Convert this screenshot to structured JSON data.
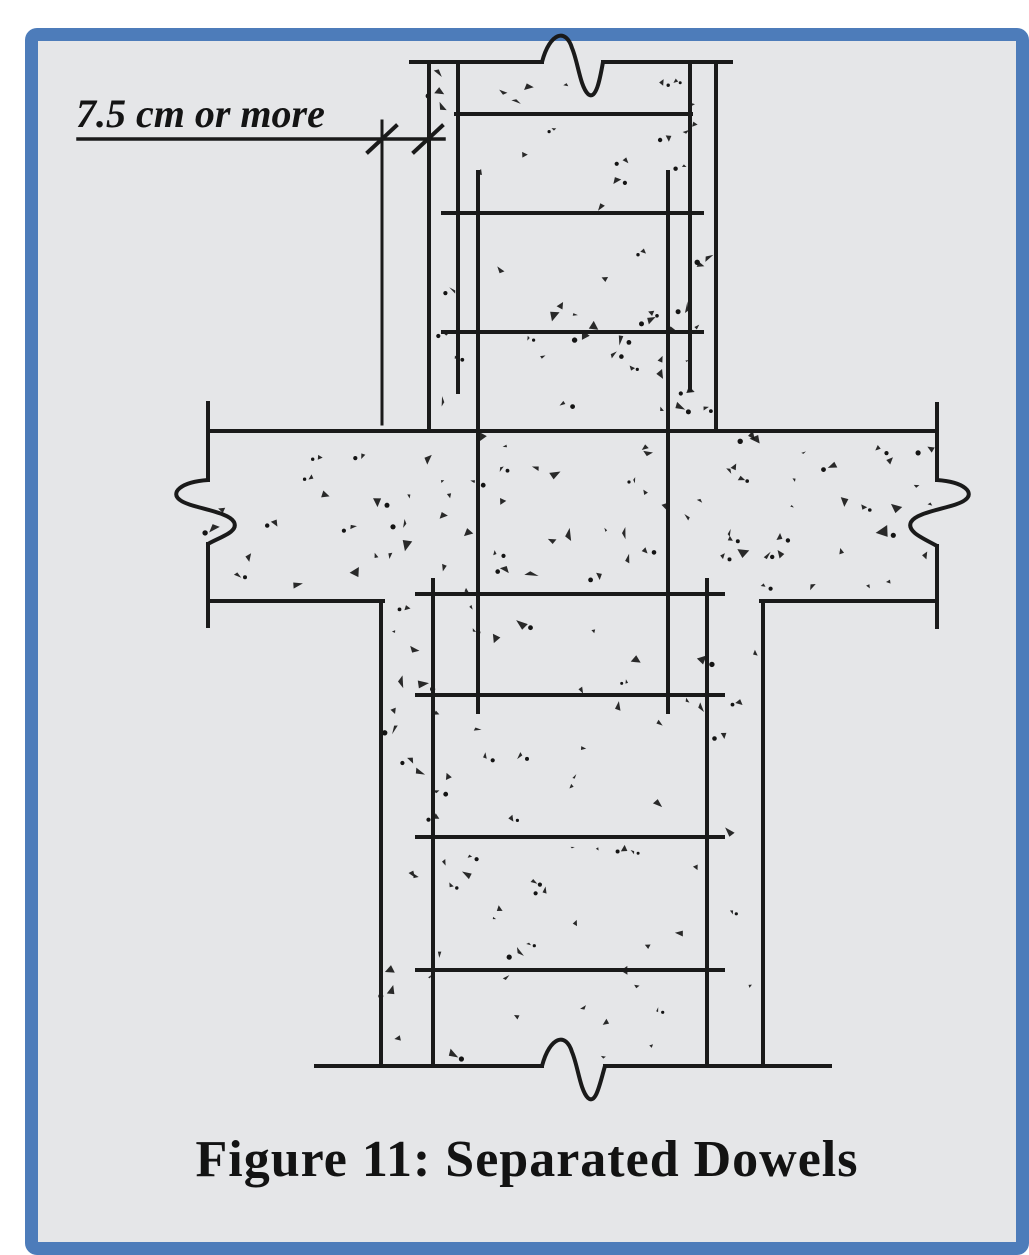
{
  "figure": {
    "annotation": "7.5 cm or more",
    "caption": "Figure 11: Separated Dowels"
  },
  "colors": {
    "frame_blue": "#4d7cba",
    "canvas_gray": "#e5e6e8",
    "line_black": "#1a1a1a",
    "stipple_black": "#141414",
    "page_white": "#ffffff"
  },
  "drawing": {
    "lines": [
      {
        "n": "dimension-line",
        "x1": 78,
        "y1": 139,
        "x2": 444,
        "y2": 139,
        "w": 3.5
      },
      {
        "n": "dimension-extension-line",
        "x1": 382,
        "y1": 121,
        "x2": 382,
        "y2": 424,
        "w": 3
      },
      {
        "n": "dimension-tick-left",
        "x1": 368,
        "y1": 152,
        "x2": 396,
        "y2": 126,
        "w": 4
      },
      {
        "n": "dimension-tick-right",
        "x1": 414,
        "y1": 152,
        "x2": 442,
        "y2": 126,
        "w": 4
      },
      {
        "n": "upper-column-top-edge-left",
        "x1": 411,
        "y1": 62,
        "x2": 542,
        "y2": 62,
        "w": 4
      },
      {
        "n": "upper-column-top-edge-right",
        "x1": 603,
        "y1": 62,
        "x2": 731,
        "y2": 62,
        "w": 4
      },
      {
        "n": "upper-column-left-edge",
        "x1": 429,
        "y1": 62,
        "x2": 429,
        "y2": 431,
        "w": 4
      },
      {
        "n": "upper-column-right-edge",
        "x1": 716,
        "y1": 62,
        "x2": 716,
        "y2": 431,
        "w": 4
      },
      {
        "n": "upper-column-rebar-left",
        "x1": 458,
        "y1": 62,
        "x2": 458,
        "y2": 392,
        "w": 4
      },
      {
        "n": "upper-column-rebar-right",
        "x1": 690,
        "y1": 62,
        "x2": 690,
        "y2": 390,
        "w": 4
      },
      {
        "n": "dowel-bar-left",
        "x1": 478,
        "y1": 172,
        "x2": 478,
        "y2": 712,
        "w": 4
      },
      {
        "n": "dowel-bar-right",
        "x1": 668,
        "y1": 172,
        "x2": 668,
        "y2": 712,
        "w": 4
      },
      {
        "n": "upper-column-tie-1",
        "x1": 456,
        "y1": 114,
        "x2": 691,
        "y2": 114,
        "w": 4
      },
      {
        "n": "upper-column-tie-2",
        "x1": 443,
        "y1": 213,
        "x2": 702,
        "y2": 213,
        "w": 4
      },
      {
        "n": "upper-column-tie-3",
        "x1": 443,
        "y1": 332,
        "x2": 702,
        "y2": 332,
        "w": 4
      },
      {
        "n": "slab-top-edge",
        "x1": 208,
        "y1": 431,
        "x2": 937,
        "y2": 431,
        "w": 4
      },
      {
        "n": "slab-bottom-edge-left",
        "x1": 208,
        "y1": 601,
        "x2": 383,
        "y2": 601,
        "w": 4
      },
      {
        "n": "slab-bottom-edge-right",
        "x1": 761,
        "y1": 601,
        "x2": 937,
        "y2": 601,
        "w": 4
      },
      {
        "n": "slab-left-edge-upper",
        "x1": 208,
        "y1": 403,
        "x2": 208,
        "y2": 480,
        "w": 4
      },
      {
        "n": "slab-left-edge-lower",
        "x1": 208,
        "y1": 544,
        "x2": 208,
        "y2": 626,
        "w": 4
      },
      {
        "n": "slab-right-edge-upper",
        "x1": 937,
        "y1": 404,
        "x2": 937,
        "y2": 480,
        "w": 4
      },
      {
        "n": "slab-right-edge-lower",
        "x1": 937,
        "y1": 546,
        "x2": 937,
        "y2": 627,
        "w": 4
      },
      {
        "n": "lower-column-left-edge",
        "x1": 381,
        "y1": 601,
        "x2": 381,
        "y2": 1066,
        "w": 4
      },
      {
        "n": "lower-column-right-edge",
        "x1": 763,
        "y1": 601,
        "x2": 763,
        "y2": 1066,
        "w": 4
      },
      {
        "n": "lower-column-rebar-left",
        "x1": 433,
        "y1": 580,
        "x2": 433,
        "y2": 1066,
        "w": 4
      },
      {
        "n": "lower-column-rebar-right",
        "x1": 707,
        "y1": 580,
        "x2": 707,
        "y2": 1066,
        "w": 4
      },
      {
        "n": "lower-column-tie-1",
        "x1": 417,
        "y1": 594,
        "x2": 723,
        "y2": 594,
        "w": 4
      },
      {
        "n": "lower-column-tie-2",
        "x1": 417,
        "y1": 695,
        "x2": 723,
        "y2": 695,
        "w": 4
      },
      {
        "n": "lower-column-tie-3",
        "x1": 417,
        "y1": 837,
        "x2": 723,
        "y2": 837,
        "w": 4
      },
      {
        "n": "lower-column-tie-4",
        "x1": 417,
        "y1": 970,
        "x2": 723,
        "y2": 970,
        "w": 4
      },
      {
        "n": "lower-column-base-left",
        "x1": 316,
        "y1": 1066,
        "x2": 542,
        "y2": 1066,
        "w": 4
      },
      {
        "n": "lower-column-base-right",
        "x1": 605,
        "y1": 1066,
        "x2": 830,
        "y2": 1066,
        "w": 4
      }
    ],
    "paths": [
      {
        "n": "break-symbol-top",
        "d": "M542,62 C550,32 566,28 572,48 C578,62 580,86 588,94 C596,101 600,79 603,62",
        "w": 4
      },
      {
        "n": "break-symbol-bottom",
        "d": "M542,1066 C550,1036 566,1032 572,1052 C578,1066 580,1090 588,1098 C596,1105 600,1083 605,1066",
        "w": 4
      },
      {
        "n": "break-symbol-left",
        "d": "M208,480 C180,482 170,493 180,500 C190,508 228,511 234,522 C239,532 220,537 208,544",
        "w": 4
      },
      {
        "n": "break-symbol-right",
        "d": "M937,480 C965,482 975,493 965,500 C955,508 917,511 911,522 C906,532 925,539 937,546",
        "w": 4
      }
    ],
    "stipple": {
      "seed": 7,
      "regions": [
        {
          "x": 436,
          "y": 70,
          "w": 272,
          "h": 352,
          "count": 52
        },
        {
          "x": 214,
          "y": 437,
          "w": 716,
          "h": 156,
          "count": 80
        },
        {
          "x": 388,
          "y": 606,
          "w": 368,
          "h": 452,
          "count": 75
        }
      ]
    }
  }
}
